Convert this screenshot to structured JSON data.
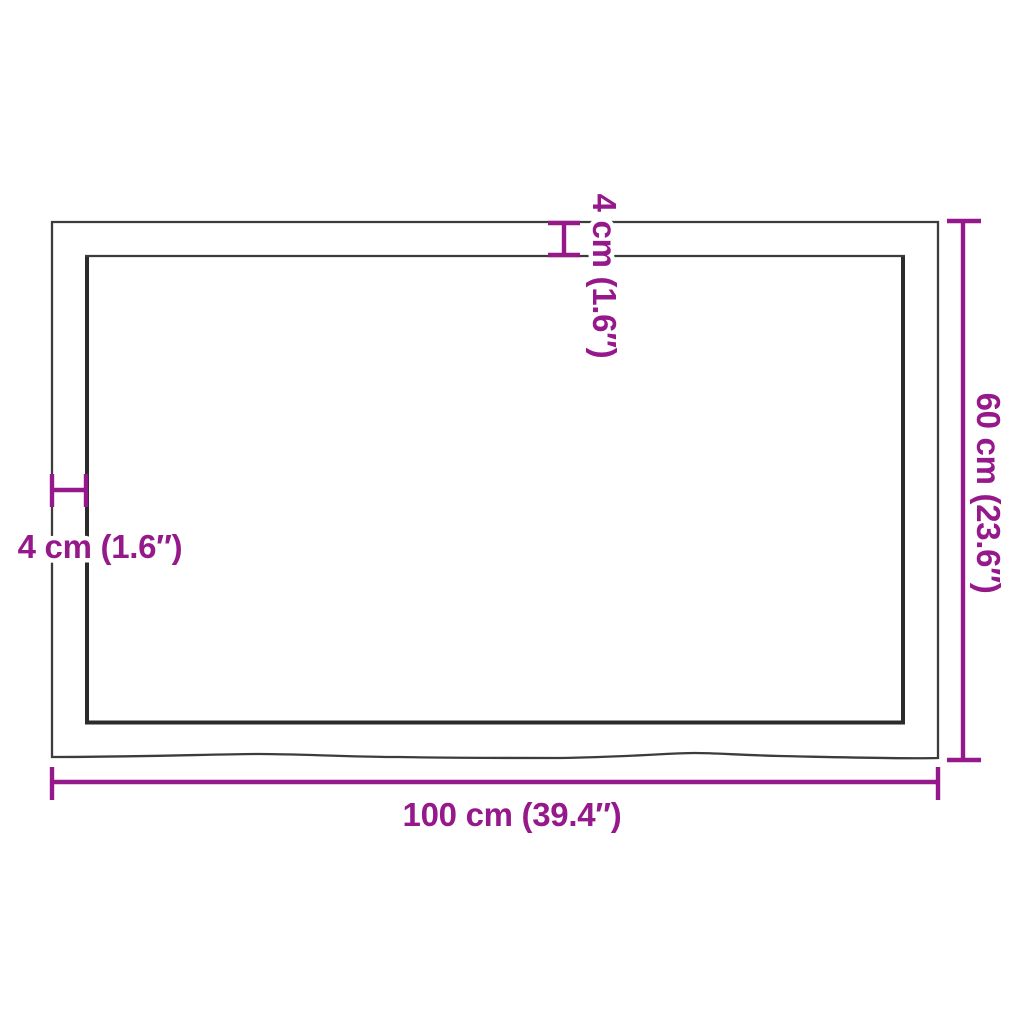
{
  "diagram": {
    "title": "Tabletop dimension diagram (top view)",
    "colors": {
      "dimension_accent": "#96198B",
      "board_outline": "#3C3C3C",
      "board_inner_edge": "#2B2B2B",
      "background": "#FFFFFF"
    },
    "dimensions": {
      "width": {
        "label": "100 cm (39.4″)",
        "cm": 100,
        "inches": 39.4,
        "position": "bottom"
      },
      "depth": {
        "label": "60 cm (23.6″)",
        "cm": 60,
        "inches": 23.6,
        "position": "right"
      },
      "edge_left": {
        "label": "4 cm (1.6″)",
        "cm": 4,
        "inches": 1.6,
        "position": "left"
      },
      "edge_top": {
        "label": "4 cm (1.6″)",
        "cm": 4,
        "inches": 1.6,
        "position": "top"
      }
    }
  }
}
